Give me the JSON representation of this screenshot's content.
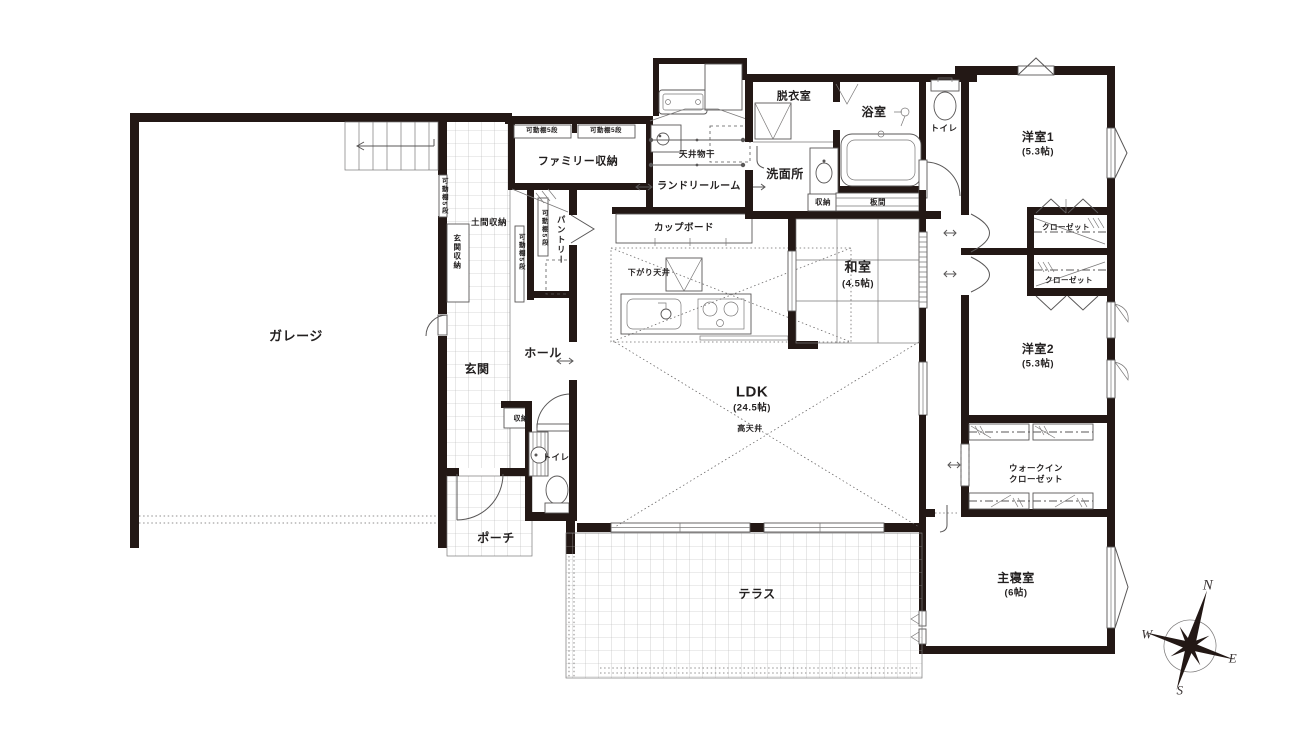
{
  "colors": {
    "wall": "#231815",
    "line": "#595757",
    "tile": "#b3b3b3",
    "text": "#221f1f"
  },
  "labels": [
    {
      "n": "garage-label",
      "t": "ガレージ",
      "x": 296,
      "y": 336,
      "s": 13
    },
    {
      "n": "genkan-label",
      "t": "玄関",
      "x": 477,
      "y": 369,
      "s": 12
    },
    {
      "n": "hall-label",
      "t": "ホール",
      "x": 543,
      "y": 353,
      "s": 12
    },
    {
      "n": "porch-label",
      "t": "ポーチ",
      "x": 496,
      "y": 538,
      "s": 12
    },
    {
      "n": "doma-storage-label",
      "t": "土間収納",
      "x": 489,
      "y": 222,
      "s": 8.5
    },
    {
      "n": "genkan-storage-label",
      "t": "玄関収納",
      "x": 457,
      "y": 252,
      "s": 7.5,
      "v": 1
    },
    {
      "n": "shelf5-label-1",
      "t": "可動棚5段",
      "x": 443,
      "y": 196,
      "s": 6.5,
      "v": 1
    },
    {
      "n": "shelf5-label-2",
      "t": "可動棚5段",
      "x": 520,
      "y": 252,
      "s": 6.5,
      "v": 1
    },
    {
      "n": "shelf5-label-3",
      "t": "可動棚5段",
      "x": 543,
      "y": 228,
      "s": 6.5,
      "v": 1
    },
    {
      "n": "pantry-label",
      "t": "パントリー",
      "x": 561,
      "y": 240,
      "s": 8.5,
      "v": 1
    },
    {
      "n": "family-storage-label",
      "t": "ファミリー収納",
      "x": 578,
      "y": 162,
      "s": 11
    },
    {
      "n": "shelf5-label-4",
      "t": "可動棚5段",
      "x": 542,
      "y": 131,
      "s": 6.5
    },
    {
      "n": "shelf5-label-5",
      "t": "可動棚5段",
      "x": 606,
      "y": 131,
      "s": 6.5
    },
    {
      "n": "laundry-room-label",
      "t": "ランドリールーム",
      "x": 699,
      "y": 187,
      "s": 10
    },
    {
      "n": "ceiling-drying-label",
      "t": "天井物干",
      "x": 697,
      "y": 154,
      "s": 8.5
    },
    {
      "n": "cupboard-label",
      "t": "カップボード",
      "x": 684,
      "y": 228,
      "s": 9.5
    },
    {
      "n": "lowered-ceiling-label",
      "t": "下がり天井",
      "x": 649,
      "y": 273,
      "s": 8
    },
    {
      "n": "ldk-label",
      "t": "LDK",
      "x": 752,
      "y": 392,
      "s": 15
    },
    {
      "n": "ldk-size-label",
      "t": "(24.5帖)",
      "x": 752,
      "y": 408,
      "s": 9.5
    },
    {
      "n": "high-ceiling-label",
      "t": "高天井",
      "x": 750,
      "y": 429,
      "s": 8
    },
    {
      "n": "washitsu-label",
      "t": "和室",
      "x": 858,
      "y": 267,
      "s": 13
    },
    {
      "n": "washitsu-size-label",
      "t": "(4.5帖)",
      "x": 858,
      "y": 284,
      "s": 9.5
    },
    {
      "n": "itanoma-label",
      "t": "板間",
      "x": 878,
      "y": 202,
      "s": 7.5
    },
    {
      "n": "senmenjo-storage-label",
      "t": "収納",
      "x": 823,
      "y": 202,
      "s": 7.5
    },
    {
      "n": "senmenjo-label",
      "t": "洗面所",
      "x": 785,
      "y": 174,
      "s": 12
    },
    {
      "n": "datsuishitsu-label",
      "t": "脱衣室",
      "x": 794,
      "y": 97,
      "s": 11
    },
    {
      "n": "yokushitsu-label",
      "t": "浴室",
      "x": 874,
      "y": 112,
      "s": 12
    },
    {
      "n": "toilet-north-label",
      "t": "トイレ",
      "x": 944,
      "y": 128,
      "s": 8.5
    },
    {
      "n": "yoshitsu1-label",
      "t": "洋室1",
      "x": 1038,
      "y": 137,
      "s": 12
    },
    {
      "n": "yoshitsu1-size-label",
      "t": "(5.3帖)",
      "x": 1038,
      "y": 152,
      "s": 9.5
    },
    {
      "n": "closet1-label",
      "t": "クローゼット",
      "x": 1066,
      "y": 227,
      "s": 7.5
    },
    {
      "n": "closet2-label",
      "t": "クローゼット",
      "x": 1069,
      "y": 280,
      "s": 7.5
    },
    {
      "n": "yoshitsu2-label",
      "t": "洋室2",
      "x": 1038,
      "y": 349,
      "s": 12
    },
    {
      "n": "yoshitsu2-size-label",
      "t": "(5.3帖)",
      "x": 1038,
      "y": 364,
      "s": 9.5
    },
    {
      "n": "wic-label-line1",
      "t": "ウォークイン",
      "x": 1036,
      "y": 468,
      "s": 8.5
    },
    {
      "n": "wic-label-line2",
      "t": "クローゼット",
      "x": 1036,
      "y": 479,
      "s": 8.5
    },
    {
      "n": "master-bedroom-label",
      "t": "主寝室",
      "x": 1016,
      "y": 578,
      "s": 12
    },
    {
      "n": "master-bedroom-size-label",
      "t": "(6帖)",
      "x": 1016,
      "y": 593,
      "s": 9.5
    },
    {
      "n": "toilet-south-label",
      "t": "トイレ",
      "x": 556,
      "y": 457,
      "s": 8.5
    },
    {
      "n": "hall-storage-label",
      "t": "収納",
      "x": 521,
      "y": 419,
      "s": 7
    },
    {
      "n": "terrace-label",
      "t": "テラス",
      "x": 757,
      "y": 594,
      "s": 12
    },
    {
      "n": "compass-n",
      "t": "N",
      "x": 1208,
      "y": 586,
      "s": 15,
      "f": 1
    },
    {
      "n": "compass-w",
      "t": "W",
      "x": 1147,
      "y": 634,
      "s": 13,
      "f": 1
    },
    {
      "n": "compass-e",
      "t": "E",
      "x": 1233,
      "y": 658,
      "s": 13,
      "f": 1
    },
    {
      "n": "compass-s",
      "t": "S",
      "x": 1180,
      "y": 690,
      "s": 13,
      "f": 1
    }
  ]
}
